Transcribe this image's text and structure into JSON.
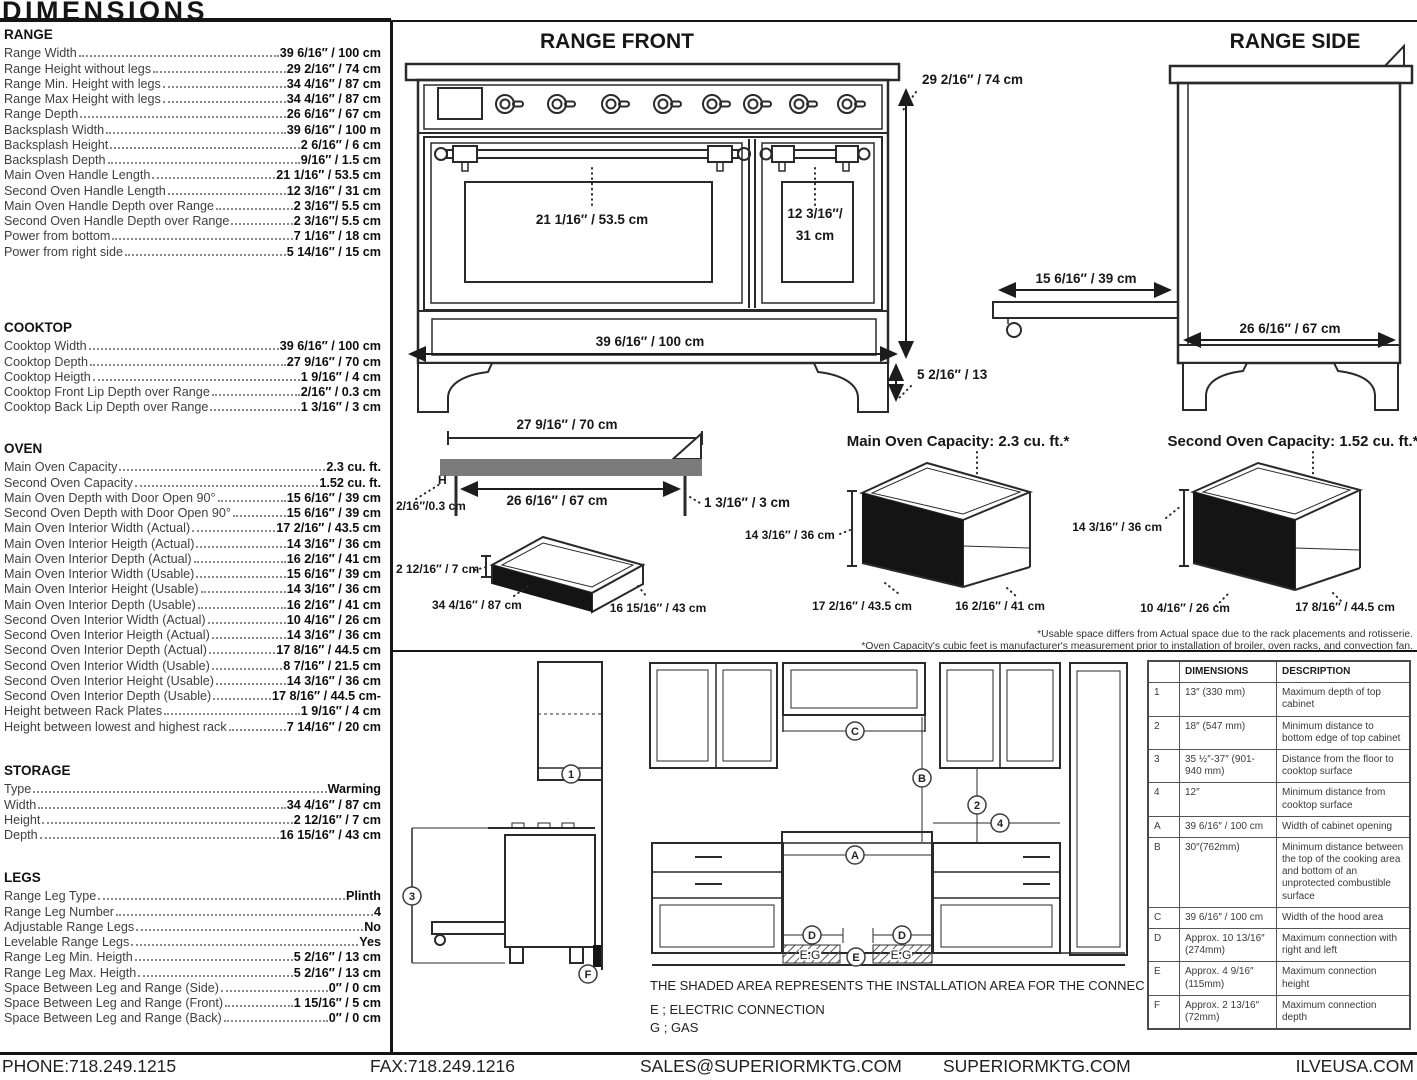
{
  "title": "DIMENSIONS",
  "specs": {
    "range": {
      "title": "RANGE",
      "rows": [
        {
          "label": "Range Width",
          "value": "39 6/16″ / 100 cm"
        },
        {
          "label": "Range Height without legs",
          "value": "29 2/16″ / 74 cm"
        },
        {
          "label": "Range Min. Height with legs",
          "value": "34 4/16″ / 87 cm"
        },
        {
          "label": "Range Max Height with legs",
          "value": "34 4/16″ / 87 cm"
        },
        {
          "label": "Range Depth",
          "value": "26 6/16″ / 67 cm"
        },
        {
          "label": "Backsplash Width",
          "value": "39 6/16″ / 100 m"
        },
        {
          "label": "Backsplash Height",
          "value": "2 6/16″ / 6 cm"
        },
        {
          "label": "Backsplash Depth",
          "value": "9/16″ / 1.5 cm"
        },
        {
          "label": "Main Oven Handle Length",
          "value": "21 1/16″ / 53.5 cm"
        },
        {
          "label": "Second Oven Handle Length",
          "value": "12 3/16″ / 31 cm"
        },
        {
          "label": "Main Oven Handle Depth over Range",
          "value": "2 3/16″/ 5.5 cm"
        },
        {
          "label": "Second Oven Handle Depth over Range",
          "value": "2 3/16″/ 5.5 cm"
        },
        {
          "label": "Power from bottom",
          "value": "7 1/16″ / 18 cm"
        },
        {
          "label": "Power from right side",
          "value": "5 14/16″ / 15 cm"
        }
      ]
    },
    "cooktop": {
      "title": "COOKTOP",
      "rows": [
        {
          "label": "Cooktop Width",
          "value": "39 6/16″ / 100 cm"
        },
        {
          "label": "Cooktop Depth",
          "value": "27 9/16″ / 70 cm"
        },
        {
          "label": "Cooktop Heigth",
          "value": "1 9/16″ / 4 cm"
        },
        {
          "label": "Cooktop Front Lip Depth over Range",
          "value": "2/16″ / 0.3 cm"
        },
        {
          "label": "Cooktop Back Lip Depth over Range",
          "value": "1 3/16″ / 3 cm"
        }
      ]
    },
    "oven": {
      "title": "OVEN",
      "rows": [
        {
          "label": "Main Oven Capacity",
          "value": "2.3 cu. ft."
        },
        {
          "label": "Second Oven Capacity",
          "value": "1.52 cu. ft."
        },
        {
          "label": "Main Oven Depth with Door Open 90°",
          "value": "15 6/16″ / 39 cm"
        },
        {
          "label": "Second Oven Depth with Door Open 90°",
          "value": "15 6/16″ / 39 cm"
        },
        {
          "label": "Main Oven Interior Width (Actual)",
          "value": "17 2/16″ / 43.5 cm"
        },
        {
          "label": "Main Oven Interior Heigth (Actual)",
          "value": "14 3/16″ / 36 cm"
        },
        {
          "label": "Main Oven Interior Depth (Actual)",
          "value": "16 2/16″ / 41 cm"
        },
        {
          "label": "Main Oven Interior Width (Usable)",
          "value": "15 6/16″ / 39 cm"
        },
        {
          "label": "Main Oven Interior Height (Usable)",
          "value": "14 3/16″ / 36 cm"
        },
        {
          "label": "Main Oven Interior Depth (Usable)",
          "value": "16 2/16″ / 41 cm"
        },
        {
          "label": "Second Oven Interior Width (Actual)",
          "value": "10 4/16″ / 26 cm"
        },
        {
          "label": "Second Oven Interior Heigth (Actual)",
          "value": "14 3/16″ / 36 cm"
        },
        {
          "label": "Second Oven Interior Depth (Actual)",
          "value": "17 8/16″ / 44.5 cm"
        },
        {
          "label": "Second Oven Interior Width (Usable)",
          "value": "8 7/16″ / 21.5 cm"
        },
        {
          "label": "Second Oven Interior Height (Usable)",
          "value": "14 3/16″ / 36 cm"
        },
        {
          "label": "Second Oven Interior Depth (Usable)",
          "value": "17 8/16″ / 44.5 cm-"
        },
        {
          "label": "Height between Rack Plates",
          "value": "1 9/16″ / 4 cm"
        },
        {
          "label": "Height between lowest and highest rack",
          "value": "7 14/16″ / 20 cm"
        }
      ]
    },
    "storage": {
      "title": "STORAGE",
      "rows": [
        {
          "label": "Type",
          "value": "Warming"
        },
        {
          "label": "Width",
          "value": "34 4/16″ / 87 cm"
        },
        {
          "label": "Height",
          "value": "2 12/16″ / 7 cm"
        },
        {
          "label": "Depth",
          "value": "16 15/16″ / 43 cm"
        }
      ]
    },
    "legs": {
      "title": "LEGS",
      "rows": [
        {
          "label": "Range Leg Type",
          "value": "Plinth"
        },
        {
          "label": "Range Leg Number",
          "value": "4"
        },
        {
          "label": "Adjustable Range Legs",
          "value": "No"
        },
        {
          "label": "Levelable Range Legs",
          "value": "Yes"
        },
        {
          "label": "Range Leg Min. Heigth",
          "value": "5 2/16″ / 13 cm"
        },
        {
          "label": "Range Leg Max. Heigth",
          "value": "5 2/16″ / 13 cm"
        },
        {
          "label": "Space Between Leg and Range (Side)",
          "value": "0″ / 0 cm"
        },
        {
          "label": "Space Between Leg and Range (Front)",
          "value": "1 15/16″ / 5 cm"
        },
        {
          "label": "Space Between Leg and Range (Back)",
          "value": "0″ / 0 cm"
        }
      ]
    }
  },
  "front": {
    "title": "RANGE FRONT",
    "height": "29 2/16″ / 74 cm",
    "main_handle": "21 1/16″ / 53.5 cm",
    "second_handle_a": "12 3/16″/",
    "second_handle_b": "31 cm",
    "width": "39 6/16″ / 100 cm",
    "leg": "5 2/16″ / 13"
  },
  "side": {
    "title": "RANGE SIDE",
    "door": "15 6/16″ / 39 cm",
    "depth": "26 6/16″ / 67 cm"
  },
  "cooktop_profile": {
    "top": "27 9/16″ / 70 cm",
    "width": "26 6/16″ / 67 cm",
    "front_lip": "2/16″/0.3 cm",
    "back_lip": "1 3/16″ / 3 cm",
    "h": "H"
  },
  "drawer": {
    "height": "2 12/16″ / 7 cm",
    "width": "34 4/16″ / 87 cm",
    "depth": "16 15/16″ / 43 cm"
  },
  "main_oven_box": {
    "title": "Main Oven Capacity: 2.3 cu. ft.*",
    "height": "14 3/16″ / 36 cm",
    "width": "17 2/16″ / 43.5 cm",
    "depth": "16 2/16″ / 41 cm"
  },
  "second_oven_box": {
    "title": "Second Oven Capacity: 1.52 cu. ft.*",
    "height": "14 3/16″ / 36 cm",
    "width": "10 4/16″ / 26 cm",
    "depth": "17 8/16″ / 44.5 cm"
  },
  "footnotes": {
    "line1": "*Usable space differs from Actual space due to the rack placements and rotisserie.",
    "line2": "*Oven Capacity's cubic feet is manufacturer's measurement prior to installation of broiler, oven racks, and convection fan."
  },
  "installation": {
    "note": "THE SHADED AREA REPRESENTS THE INSTALLATION AREA FOR THE CONNECTIONS;",
    "legend_e": "E ; ELECTRIC CONNECTION",
    "legend_g": "G ; GAS",
    "eg": "E.G",
    "markers": {
      "n1": "1",
      "n2": "2",
      "n3": "3",
      "n4": "4",
      "a": "A",
      "b": "B",
      "c": "C",
      "d": "D",
      "e": "E",
      "f": "F"
    }
  },
  "conn_table": {
    "headers": {
      "dim": "DIMENSIONS",
      "desc": "DESCRIPTION"
    },
    "rows": [
      {
        "id": "1",
        "dim": "13″ (330 mm)",
        "desc": "Maximum depth of top cabinet"
      },
      {
        "id": "2",
        "dim": "18″ (547 mm)",
        "desc": "Minimum distance to bottom edge of top cabinet"
      },
      {
        "id": "3",
        "dim": "35 ½″-37″ (901-940 mm)",
        "desc": "Distance from the floor to cooktop surface"
      },
      {
        "id": "4",
        "dim": "12″",
        "desc": "Minimum distance from cooktop surface"
      },
      {
        "id": "A",
        "dim": "39 6/16″ / 100 cm",
        "desc": "Width of cabinet opening"
      },
      {
        "id": "B",
        "dim": "30″(762mm)",
        "desc": "Minimum distance between the top of the cooking area and bottom of an unprotected combustible surface"
      },
      {
        "id": "C",
        "dim": "39 6/16″ / 100 cm",
        "desc": "Width of the hood area"
      },
      {
        "id": "D",
        "dim": "Approx. 10 13/16″ (274mm)",
        "desc": "Maximum connection with right and left"
      },
      {
        "id": "E",
        "dim": "Approx. 4 9/16″ (115mm)",
        "desc": "Maximum connection height"
      },
      {
        "id": "F",
        "dim": "Approx. 2 13/16″ (72mm)",
        "desc": "Maximum connection depth"
      }
    ]
  },
  "footer": {
    "phone": "PHONE:718.249.1215",
    "fax": "FAX:718.249.1216",
    "email": "SALES@SUPERIORMKTG.COM",
    "site": "SUPERIORMKTG.COM",
    "ilve": "ILVEUSA.COM"
  }
}
